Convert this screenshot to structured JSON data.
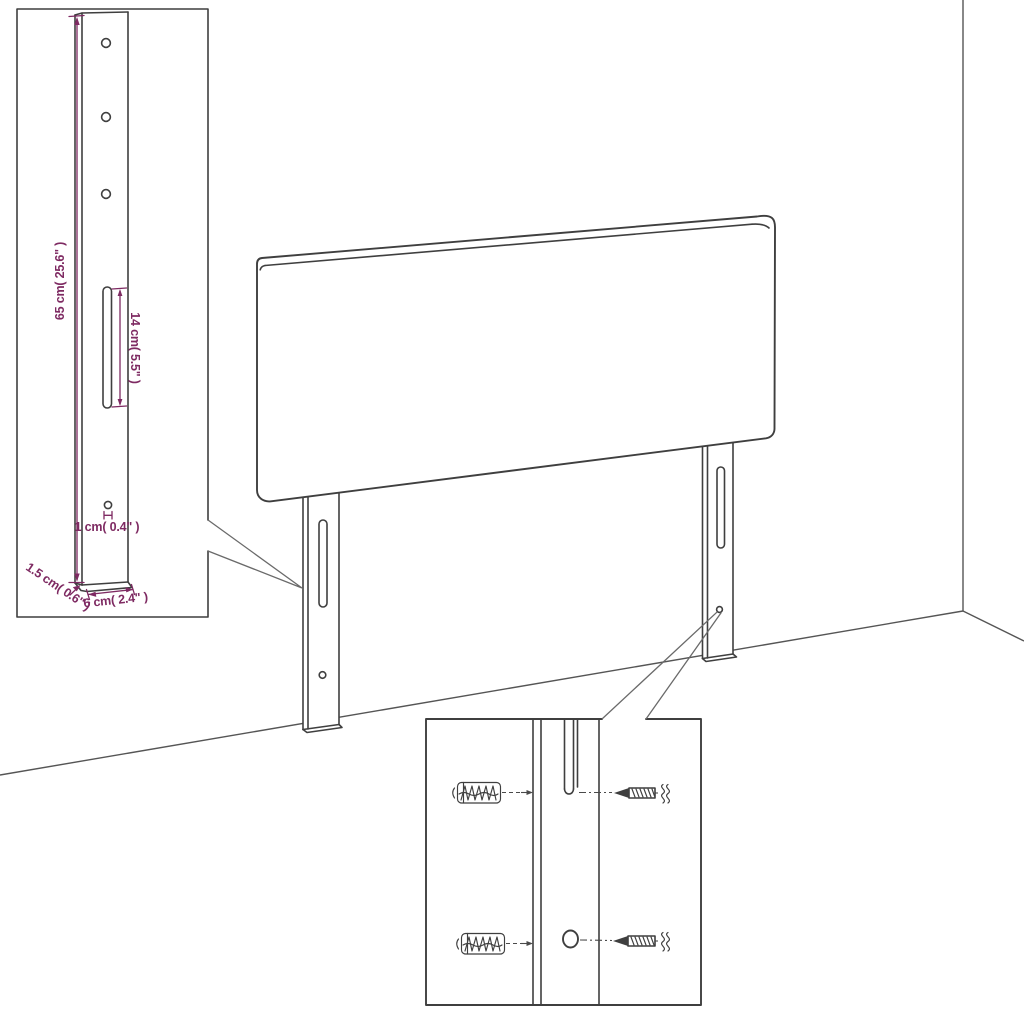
{
  "page": {
    "background": "#ffffff"
  },
  "palette": {
    "line_color": "#3f3f3f",
    "dimension_color": "#7e2a62"
  },
  "bracket_inset": {
    "height_label": "65 cm( 25.6\" )",
    "slot_length_label": "14 cm( 5.5\" )",
    "hole_label": "1 cm( 0.4\" )",
    "depth_label": "1.5 cm( 0.6\" )",
    "width_label": "6 cm( 2.4\" )"
  },
  "mounting_inset": {
    "anchor_icon": "wall-plug-icon",
    "screw_icon": "screw-icon"
  }
}
